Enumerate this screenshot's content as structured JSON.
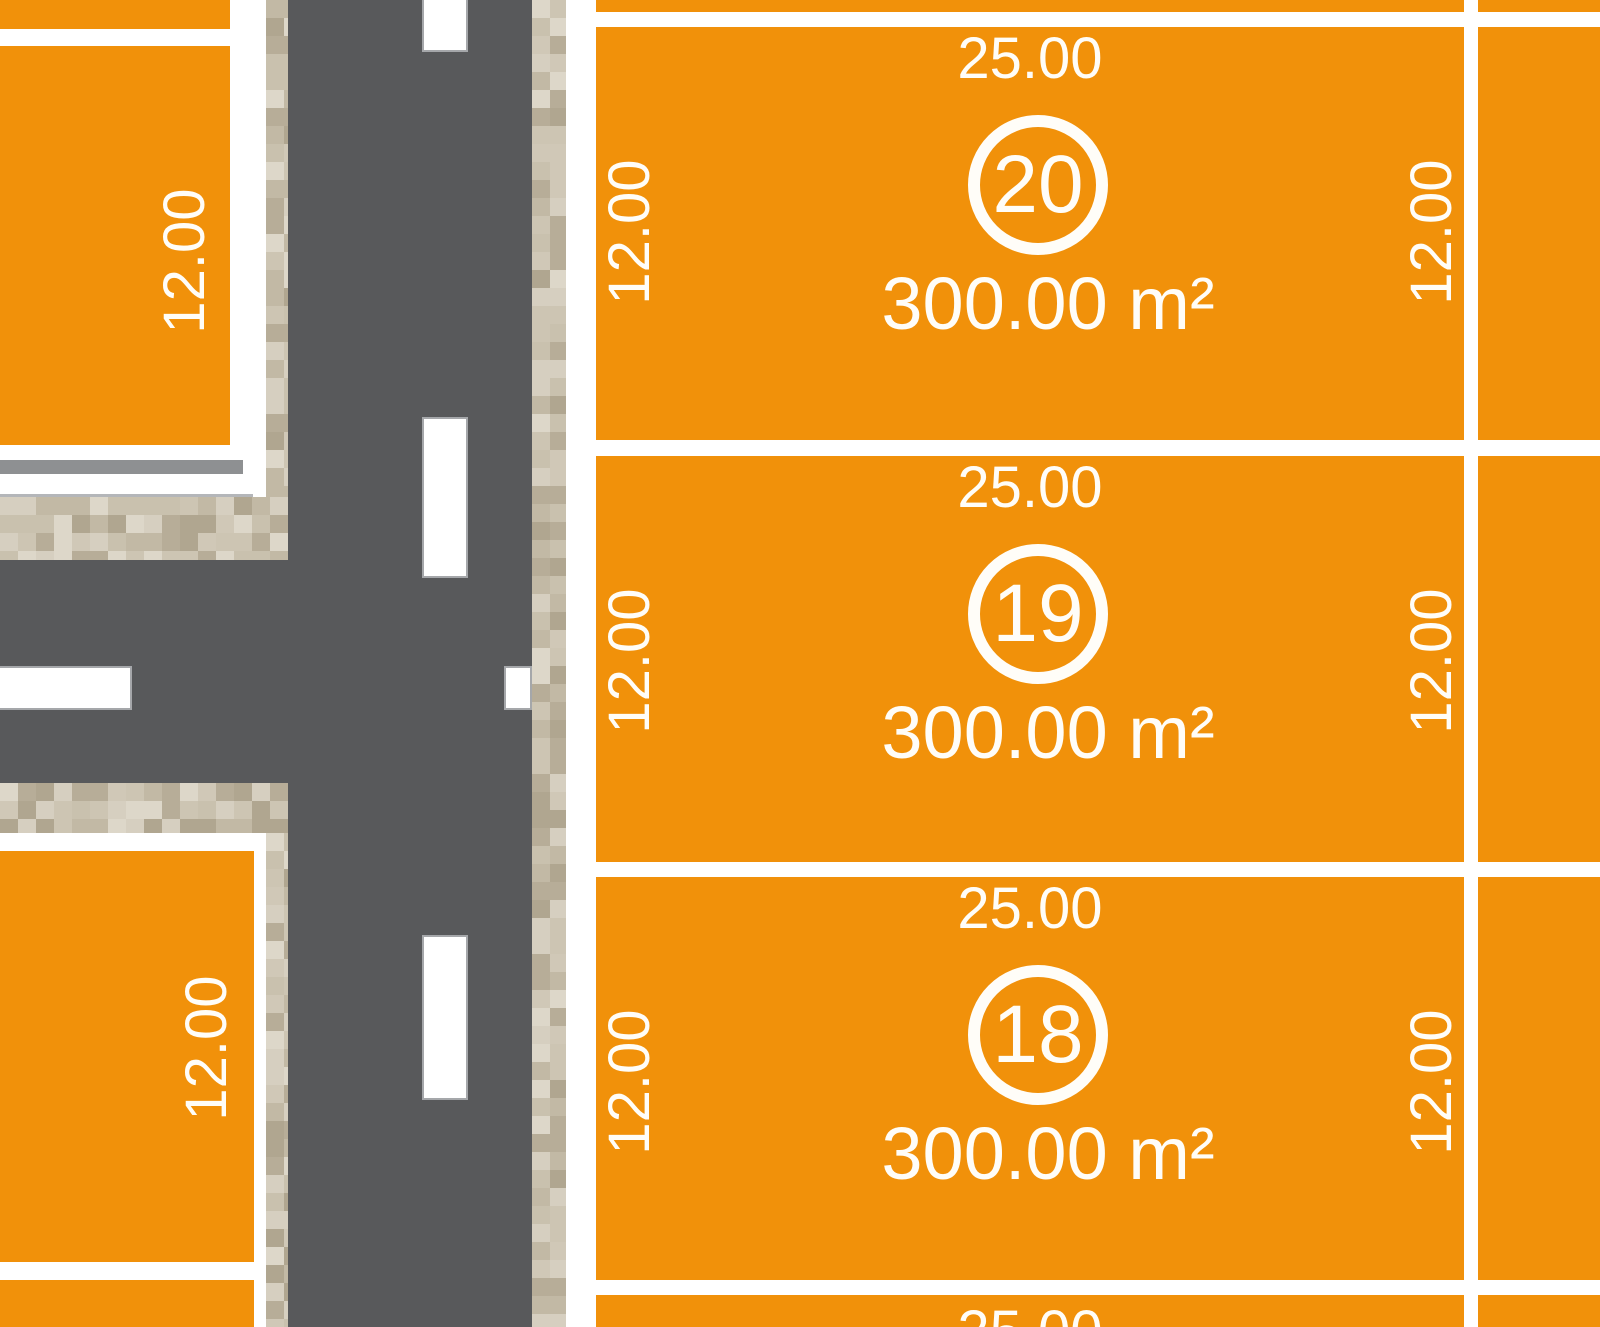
{
  "colors": {
    "plot_fill": "#F1910A",
    "road": "#58595B",
    "lane_marking": "#FFFFFF",
    "lane_marking_edge": "#A5A7AA",
    "sidewalk_base": "#C8BFAD",
    "boundary_bar": "#8E9092",
    "boundary_line": "#B4B6B9",
    "label_text": "#FFFDF8",
    "sidewalk_palette": [
      "#CDC5B3",
      "#C2B9A5",
      "#D6CFC0",
      "#B7AD98",
      "#C9C1AE",
      "#DDD7C9",
      "#B0A690",
      "#D0C8B7"
    ]
  },
  "plots": {
    "main": [
      {
        "id": "20",
        "frontage": "25.00",
        "depth_left": "12.00",
        "depth_right": "12.00",
        "area": "300.00 m²"
      },
      {
        "id": "19",
        "frontage": "25.00",
        "depth_left": "12.00",
        "depth_right": "12.00",
        "area": "300.00 m²"
      },
      {
        "id": "18",
        "frontage": "25.00",
        "depth_left": "12.00",
        "depth_right": "12.00",
        "area": "300.00 m²"
      }
    ],
    "next_partial": {
      "frontage": "25.00"
    },
    "left": [
      {
        "depth": "12.00"
      },
      {
        "depth": "12.00"
      }
    ]
  }
}
